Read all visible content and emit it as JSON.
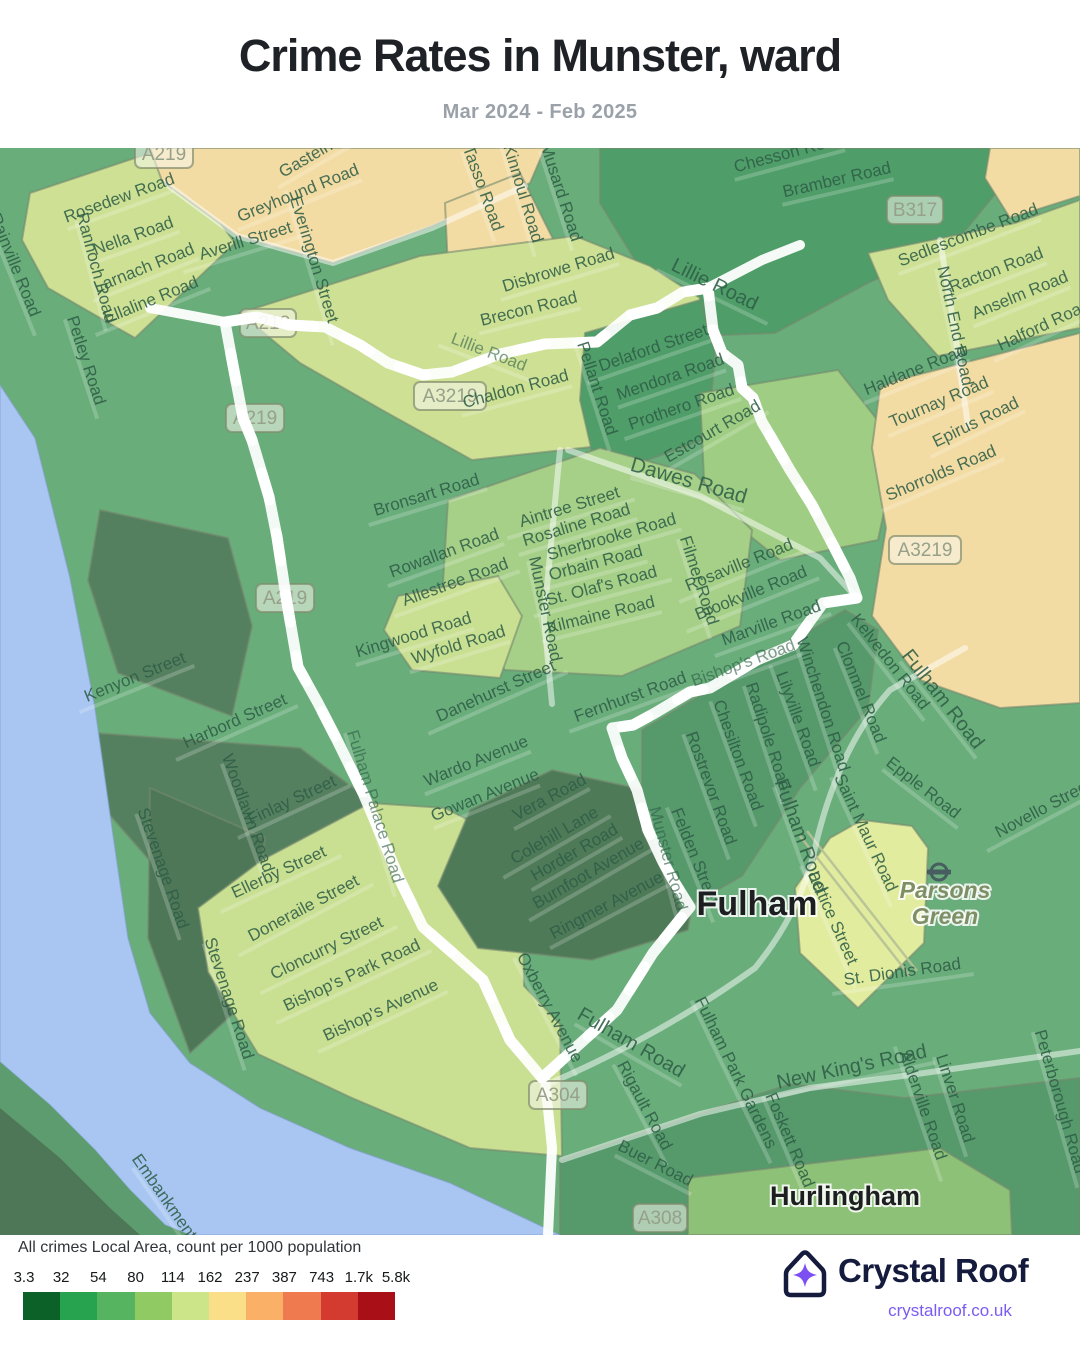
{
  "header": {
    "title": "Crime Rates in Munster, ward",
    "subtitle": "Mar 2024 - Feb 2025"
  },
  "map": {
    "boundary_color": "#5533e4",
    "river_color": "#a8c6f1",
    "place_labels": [
      {
        "t": "Fulham",
        "x": 757,
        "y": 767,
        "s": 34,
        "c": "#1c1e20",
        "w": 600,
        "i": false
      },
      {
        "t": "Parsons",
        "x": 945,
        "y": 750,
        "s": 23,
        "c": "#7e8f66",
        "w": 600,
        "i": true
      },
      {
        "t": "Green",
        "x": 945,
        "y": 776,
        "s": 23,
        "c": "#7e8f66",
        "w": 600,
        "i": true
      },
      {
        "t": "Hurlingham",
        "x": 845,
        "y": 1057,
        "s": 27,
        "c": "#1c1e20",
        "w": 600,
        "i": false
      }
    ],
    "shields": [
      {
        "t": "A219",
        "x": 164,
        "y": 6,
        "w": 58
      },
      {
        "t": "A218",
        "x": 268,
        "y": 175,
        "w": 56
      },
      {
        "t": "A3219",
        "x": 450,
        "y": 248,
        "w": 72
      },
      {
        "t": "A219",
        "x": 255,
        "y": 270,
        "w": 58
      },
      {
        "t": "A219",
        "x": 285,
        "y": 450,
        "w": 58
      },
      {
        "t": "B317",
        "x": 915,
        "y": 62,
        "w": 56
      },
      {
        "t": "A3219",
        "x": 925,
        "y": 402,
        "w": 72
      },
      {
        "t": "A304",
        "x": 558,
        "y": 947,
        "w": 58
      },
      {
        "t": "A308",
        "x": 660,
        "y": 1070,
        "w": 54
      }
    ],
    "road_labels": [
      {
        "t": "Rosedew Road",
        "x": 121,
        "y": 55,
        "r": -20
      },
      {
        "t": "Nella Road",
        "x": 135,
        "y": 93,
        "r": -20
      },
      {
        "t": "Rannoch Road",
        "x": 91,
        "y": 121,
        "r": 75
      },
      {
        "t": "Larnach Road",
        "x": 146,
        "y": 125,
        "r": -22
      },
      {
        "t": "Ellaline Road",
        "x": 153,
        "y": 157,
        "r": -22
      },
      {
        "t": "Petley Road",
        "x": 81,
        "y": 214,
        "r": 72
      },
      {
        "t": "Rainville Road",
        "x": 10,
        "y": 119,
        "r": 68
      },
      {
        "t": "Averill Street",
        "x": 247,
        "y": 98,
        "r": -17
      },
      {
        "t": "Everington Street",
        "x": 309,
        "y": 113,
        "r": 73
      },
      {
        "t": "Greyhound Road",
        "x": 300,
        "y": 50,
        "r": -22
      },
      {
        "t": "Gastein Road",
        "x": 328,
        "y": 4,
        "r": -30
      },
      {
        "t": "Tasso Road",
        "x": 478,
        "y": 42,
        "r": 70
      },
      {
        "t": "Kinnoul Road",
        "x": 518,
        "y": 47,
        "r": 73
      },
      {
        "t": "Musard Road",
        "x": 556,
        "y": 46,
        "r": 72
      },
      {
        "t": "Disbrowe Road",
        "x": 560,
        "y": 127,
        "r": -17
      },
      {
        "t": "Brecon Road",
        "x": 530,
        "y": 166,
        "r": -14
      },
      {
        "t": "Chaldon Road",
        "x": 517,
        "y": 246,
        "r": -15
      },
      {
        "t": "Lillie Road",
        "x": 712,
        "y": 142,
        "r": 26,
        "s": 20
      },
      {
        "t": "Lillie Road",
        "x": 487,
        "y": 209,
        "r": 21,
        "o": 0.6
      },
      {
        "t": "Delaford Street",
        "x": 655,
        "y": 205,
        "r": -19
      },
      {
        "t": "Mendora Road",
        "x": 672,
        "y": 234,
        "r": -19
      },
      {
        "t": "Prothero Road",
        "x": 683,
        "y": 264,
        "r": -19
      },
      {
        "t": "Estcourt Road",
        "x": 715,
        "y": 288,
        "r": -30
      },
      {
        "t": "Pellant Road",
        "x": 592,
        "y": 242,
        "r": 72
      },
      {
        "t": "Chesson Road",
        "x": 790,
        "y": 10,
        "r": -15
      },
      {
        "t": "Bramber Road",
        "x": 838,
        "y": 37,
        "r": -13
      },
      {
        "t": "Sedlescombe Road",
        "x": 970,
        "y": 92,
        "r": -21
      },
      {
        "t": "Racton Road",
        "x": 998,
        "y": 127,
        "r": -21
      },
      {
        "t": "Anselm Road",
        "x": 1022,
        "y": 152,
        "r": -22
      },
      {
        "t": "Halford Road",
        "x": 1046,
        "y": 182,
        "r": -25
      },
      {
        "t": "North End Road",
        "x": 950,
        "y": 179,
        "r": 78
      },
      {
        "t": "Haldane Road",
        "x": 917,
        "y": 227,
        "r": -22
      },
      {
        "t": "Tournay Road",
        "x": 941,
        "y": 259,
        "r": -23
      },
      {
        "t": "Epirus Road",
        "x": 978,
        "y": 279,
        "r": -26
      },
      {
        "t": "Shorrolds Road",
        "x": 943,
        "y": 330,
        "r": -23
      },
      {
        "t": "Dawes Road",
        "x": 687,
        "y": 339,
        "r": 16,
        "s": 21
      },
      {
        "t": "Bronsart Road",
        "x": 428,
        "y": 352,
        "r": -17
      },
      {
        "t": "Rowallan Road",
        "x": 446,
        "y": 410,
        "r": -20
      },
      {
        "t": "Allestree Road",
        "x": 457,
        "y": 439,
        "r": -20
      },
      {
        "t": "Munster Road",
        "x": 540,
        "y": 462,
        "r": 78
      },
      {
        "t": "Aintree Street",
        "x": 571,
        "y": 364,
        "r": -17
      },
      {
        "t": "Rosaline Road",
        "x": 578,
        "y": 382,
        "r": -17
      },
      {
        "t": "Sherbrooke Road",
        "x": 613,
        "y": 394,
        "r": -16
      },
      {
        "t": "Orbain Road",
        "x": 597,
        "y": 420,
        "r": -15
      },
      {
        "t": "St. Olaf's Road",
        "x": 603,
        "y": 443,
        "r": -15
      },
      {
        "t": "Kilmaine Road",
        "x": 602,
        "y": 472,
        "r": -14
      },
      {
        "t": "Filmer Road",
        "x": 694,
        "y": 434,
        "r": 72
      },
      {
        "t": "Rosaville Road",
        "x": 741,
        "y": 422,
        "r": -22
      },
      {
        "t": "Brookville Road",
        "x": 753,
        "y": 450,
        "r": -22
      },
      {
        "t": "Marville Road",
        "x": 773,
        "y": 480,
        "r": -20
      },
      {
        "t": "Kingwood Road",
        "x": 415,
        "y": 492,
        "r": -17
      },
      {
        "t": "Wyfold Road",
        "x": 460,
        "y": 502,
        "r": -17
      },
      {
        "t": "Kenyon Street",
        "x": 137,
        "y": 534,
        "r": -22
      },
      {
        "t": "Harbord Street",
        "x": 237,
        "y": 578,
        "r": -24
      },
      {
        "t": "Danehurst Street",
        "x": 498,
        "y": 548,
        "r": -24
      },
      {
        "t": "Fernhurst Road",
        "x": 632,
        "y": 554,
        "r": -20
      },
      {
        "t": "Bishop's Road",
        "x": 745,
        "y": 520,
        "r": -20,
        "o": 0.62
      },
      {
        "t": "Winchendon Road",
        "x": 818,
        "y": 558,
        "r": 72
      },
      {
        "t": "Clonmel Road",
        "x": 856,
        "y": 546,
        "r": 68
      },
      {
        "t": "Kelvedon Road",
        "x": 886,
        "y": 517,
        "r": 52
      },
      {
        "t": "Fulham Road",
        "x": 938,
        "y": 555,
        "r": 52,
        "s": 20
      },
      {
        "t": "Rostrevor Road",
        "x": 706,
        "y": 642,
        "r": 70
      },
      {
        "t": "Chesilton Road",
        "x": 733,
        "y": 609,
        "r": 70
      },
      {
        "t": "Radipole Road",
        "x": 763,
        "y": 590,
        "r": 72
      },
      {
        "t": "Lilyville Road",
        "x": 793,
        "y": 573,
        "r": 70
      },
      {
        "t": "Felden Street",
        "x": 690,
        "y": 710,
        "r": 68
      },
      {
        "t": "Epple Road",
        "x": 920,
        "y": 644,
        "r": 38
      },
      {
        "t": "Saint Maur Road",
        "x": 861,
        "y": 687,
        "r": 65
      },
      {
        "t": "Novello Street",
        "x": 1046,
        "y": 665,
        "r": -28
      },
      {
        "t": "Fulham Road",
        "x": 795,
        "y": 690,
        "r": 70,
        "s": 20
      },
      {
        "t": "Wardo Avenue",
        "x": 478,
        "y": 618,
        "r": -22
      },
      {
        "t": "Gowan Avenue",
        "x": 487,
        "y": 652,
        "r": -22
      },
      {
        "t": "Vera Road",
        "x": 552,
        "y": 654,
        "r": -28
      },
      {
        "t": "Colehill Lane",
        "x": 557,
        "y": 692,
        "r": -30
      },
      {
        "t": "Horder Road",
        "x": 577,
        "y": 709,
        "r": -30
      },
      {
        "t": "Burnfoot Avenue",
        "x": 591,
        "y": 730,
        "r": -30
      },
      {
        "t": "Ringmer Avenue",
        "x": 609,
        "y": 762,
        "r": -28
      },
      {
        "t": "Munster Road",
        "x": 663,
        "y": 712,
        "r": 75,
        "o": 0.62
      },
      {
        "t": "Fulham Palace Road",
        "x": 370,
        "y": 660,
        "r": 73,
        "o": 0.62
      },
      {
        "t": "Oxberry Avenue",
        "x": 545,
        "y": 862,
        "r": 62
      },
      {
        "t": "Stevenage Road",
        "x": 158,
        "y": 722,
        "r": 71
      },
      {
        "t": "Stevenage Road",
        "x": 224,
        "y": 852,
        "r": 72
      },
      {
        "t": "Woodlawn Road",
        "x": 243,
        "y": 667,
        "r": 70
      },
      {
        "t": "Finlay Street",
        "x": 294,
        "y": 657,
        "r": -25
      },
      {
        "t": "Ellerby Street",
        "x": 281,
        "y": 729,
        "r": -25
      },
      {
        "t": "Doneraile Street",
        "x": 306,
        "y": 765,
        "r": -28
      },
      {
        "t": "Cloncurry Street",
        "x": 329,
        "y": 805,
        "r": -26
      },
      {
        "t": "Bishop's Park Road",
        "x": 354,
        "y": 832,
        "r": -25
      },
      {
        "t": "Bishop's Avenue",
        "x": 383,
        "y": 867,
        "r": -25
      },
      {
        "t": "Lettice Street",
        "x": 828,
        "y": 772,
        "r": 66
      },
      {
        "t": "St. Dionis Road",
        "x": 903,
        "y": 829,
        "r": -8
      },
      {
        "t": "Fulham Park Gardens",
        "x": 731,
        "y": 927,
        "r": 64
      },
      {
        "t": "New King's Road",
        "x": 853,
        "y": 925,
        "r": -12,
        "s": 20
      },
      {
        "t": "Linver Road",
        "x": 950,
        "y": 952,
        "r": 72
      },
      {
        "t": "Alderville Road",
        "x": 918,
        "y": 959,
        "r": 71
      },
      {
        "t": "Foskett Road",
        "x": 785,
        "y": 994,
        "r": 67
      },
      {
        "t": "Peterborough Road",
        "x": 1055,
        "y": 955,
        "r": 74
      },
      {
        "t": "Rigault Road",
        "x": 640,
        "y": 960,
        "r": 62
      },
      {
        "t": "Buer Road",
        "x": 653,
        "y": 1020,
        "r": 27
      },
      {
        "t": "Fulham Road",
        "x": 628,
        "y": 900,
        "r": 30,
        "s": 20
      },
      {
        "t": "Embankment",
        "x": 160,
        "y": 1052,
        "r": 55
      }
    ]
  },
  "legend": {
    "title": "All crimes Local Area, count per 1000 population",
    "ticks": [
      "3.3",
      "32",
      "54",
      "80",
      "114",
      "162",
      "237",
      "387",
      "743",
      "1.7k",
      "5.8k"
    ],
    "colors": [
      "#0b6127",
      "#27a24e",
      "#56b35f",
      "#8fca63",
      "#cce588",
      "#fade88",
      "#fab066",
      "#ef7a50",
      "#d43b30",
      "#a80f17"
    ]
  },
  "footer": {
    "brand": "Crystal Roof",
    "url": "crystalroof.co.uk"
  }
}
